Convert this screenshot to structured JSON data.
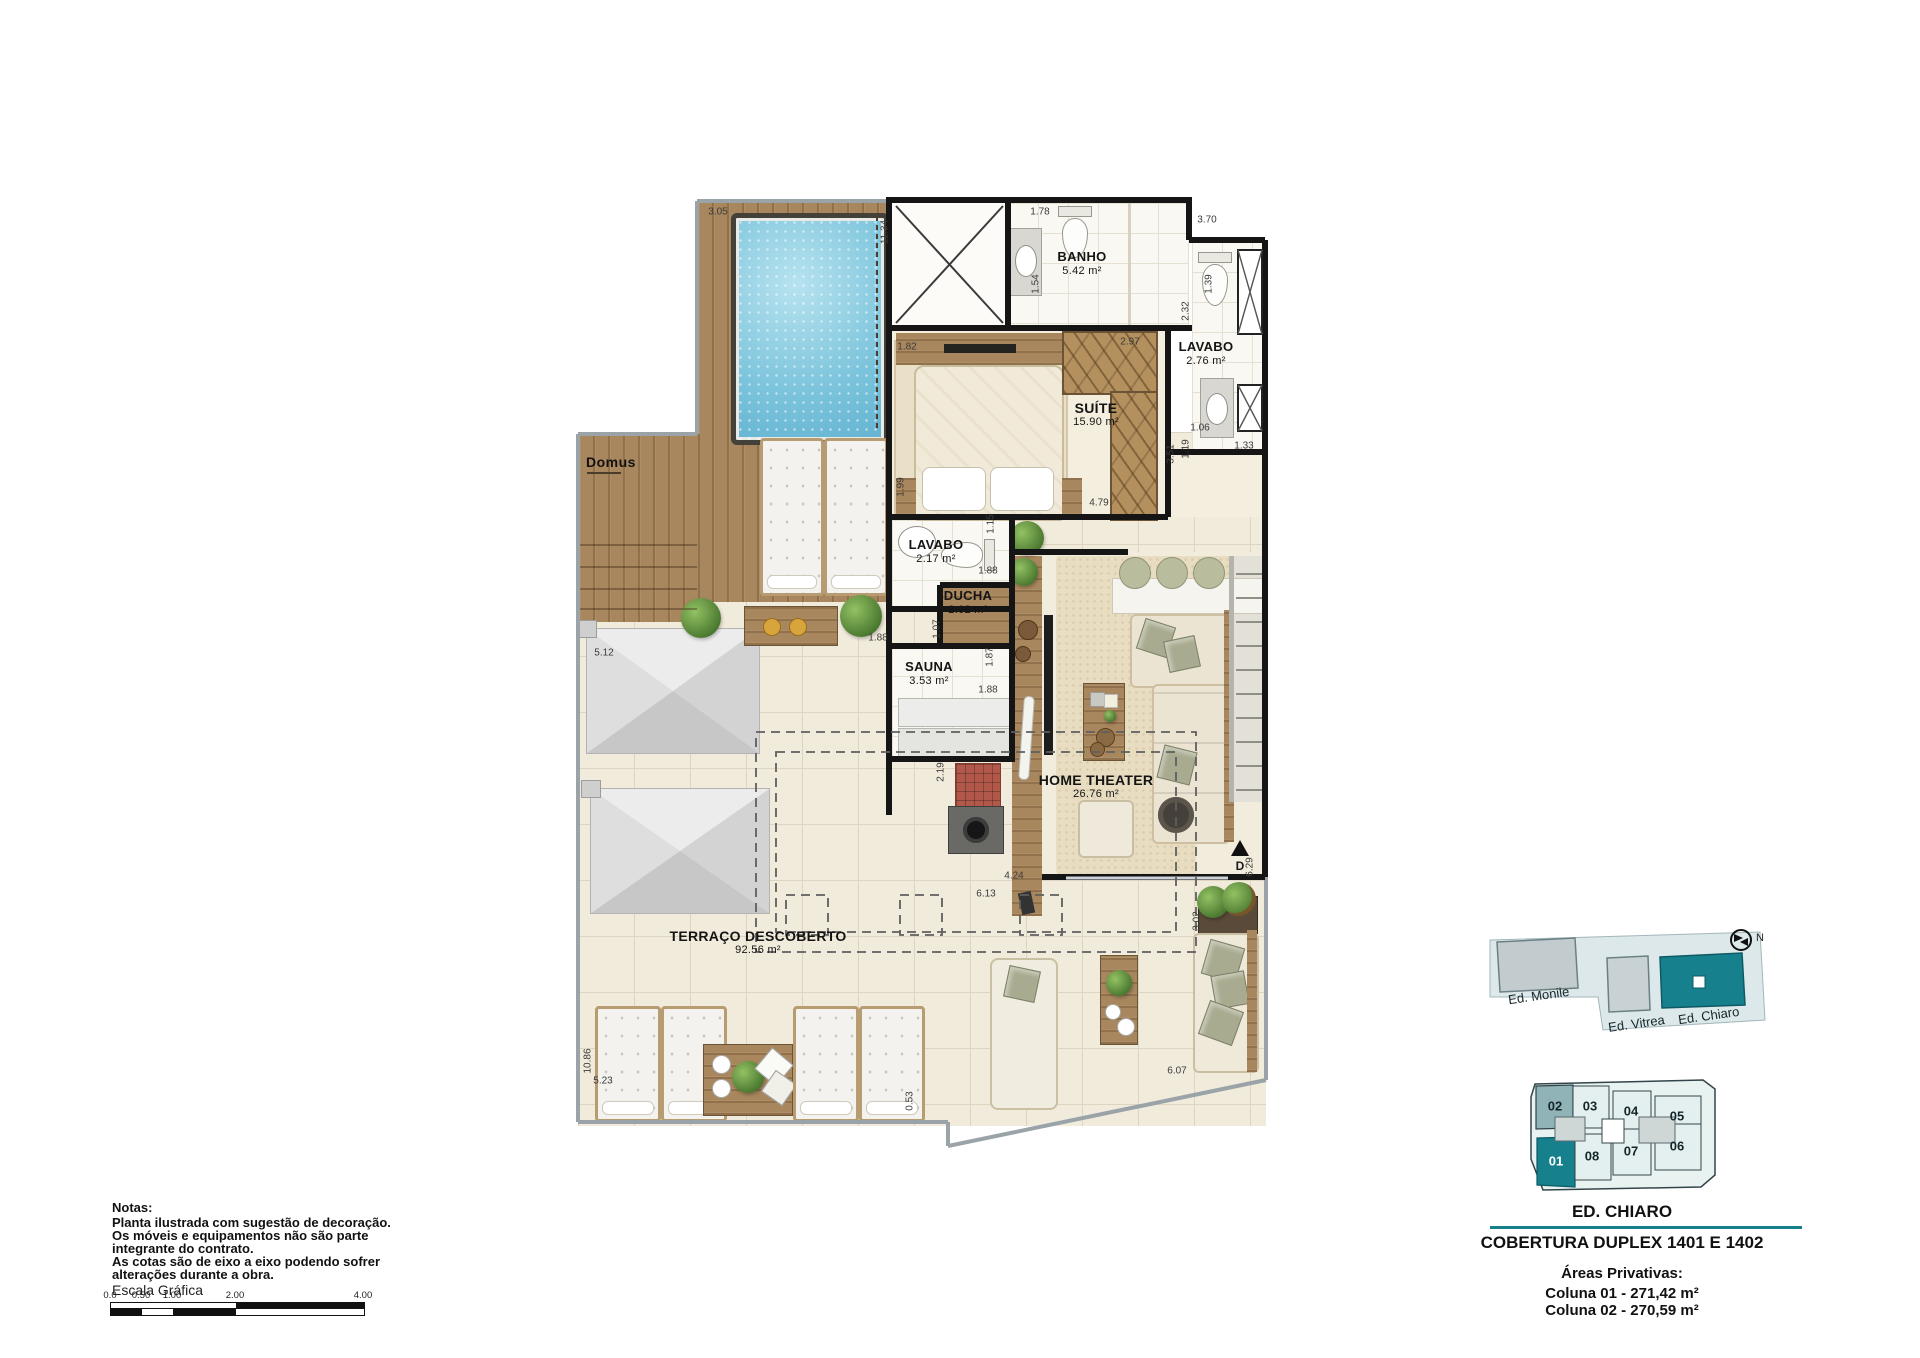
{
  "plan": {
    "logo": "Domus",
    "stair_marker": "D",
    "rooms": {
      "banho": {
        "name": "BANHO",
        "area": "5.42 m²"
      },
      "lavabo_suite": {
        "name": "LAVABO",
        "area": "2.76 m²"
      },
      "suite": {
        "name": "SUÍTE",
        "area": "15.90 m²"
      },
      "lavabo": {
        "name": "LAVABO",
        "area": "2.17 m²"
      },
      "ducha": {
        "name": "DUCHA",
        "area": "2.02 m²"
      },
      "sauna": {
        "name": "SAUNA",
        "area": "3.53 m²"
      },
      "home_theater": {
        "name": "HOME THEATER",
        "area": "26.76 m²"
      },
      "terraco": {
        "name": "TERRAÇO DESCOBERTO",
        "area": "92.56 m²"
      }
    },
    "dims": {
      "d305": "3.05",
      "d1134": "11.34",
      "d178": "1.78",
      "d370": "3.70",
      "d154": "1.54",
      "d139": "1.39",
      "d232": "2.32",
      "d297": "2.97",
      "d182": "1.82",
      "d106": "1.06",
      "d119": "1.19",
      "d351": "3.51",
      "d133": "1.33",
      "d479": "4.79",
      "d199": "1.99",
      "d115": "1.15",
      "d188a": "1.88",
      "d107": "1.07",
      "d188b": "1.88",
      "d187": "1.87",
      "d188c": "1.88",
      "d219": "2.19",
      "d424": "4.24",
      "d613": "6.13",
      "d629": "6.29",
      "d302": "3.02",
      "d607": "6.07",
      "d053": "0.53",
      "d523": "5.23",
      "d1086": "10.86",
      "d512": "5.12"
    }
  },
  "notes": {
    "title": "Notas:",
    "lines": [
      "Planta ilustrada com sugestão de decoração.",
      "Os móveis e equipamentos não são parte",
      "integrante do contrato.",
      "As cotas são de eixo a eixo podendo sofrer",
      "alterações durante a obra."
    ]
  },
  "scale_bar": {
    "label": "Escala Gráfica",
    "ticks": [
      "0.0",
      "0.50",
      "1.00",
      "2.00",
      "4.00"
    ]
  },
  "sidebar": {
    "siteplan": {
      "north": "N",
      "buildings": [
        {
          "name": "Ed. Monile"
        },
        {
          "name": "Ed. Vitrea"
        },
        {
          "name": "Ed. Chiaro"
        }
      ]
    },
    "unitplan": {
      "units": [
        "02",
        "03",
        "04",
        "05",
        "01",
        "08",
        "07",
        "06"
      ]
    },
    "building_title": "ED. CHIARO",
    "plan_title": "COBERTURA DUPLEX 1401 E 1402",
    "areas_title": "Áreas Privativas:",
    "areas": [
      "Coluna 01 - 271,42 m²",
      "Coluna 02 - 270,59 m²"
    ]
  },
  "colors": {
    "accent": "#17808d",
    "wood": "#a8875e",
    "pool": "#7cc4dc"
  }
}
